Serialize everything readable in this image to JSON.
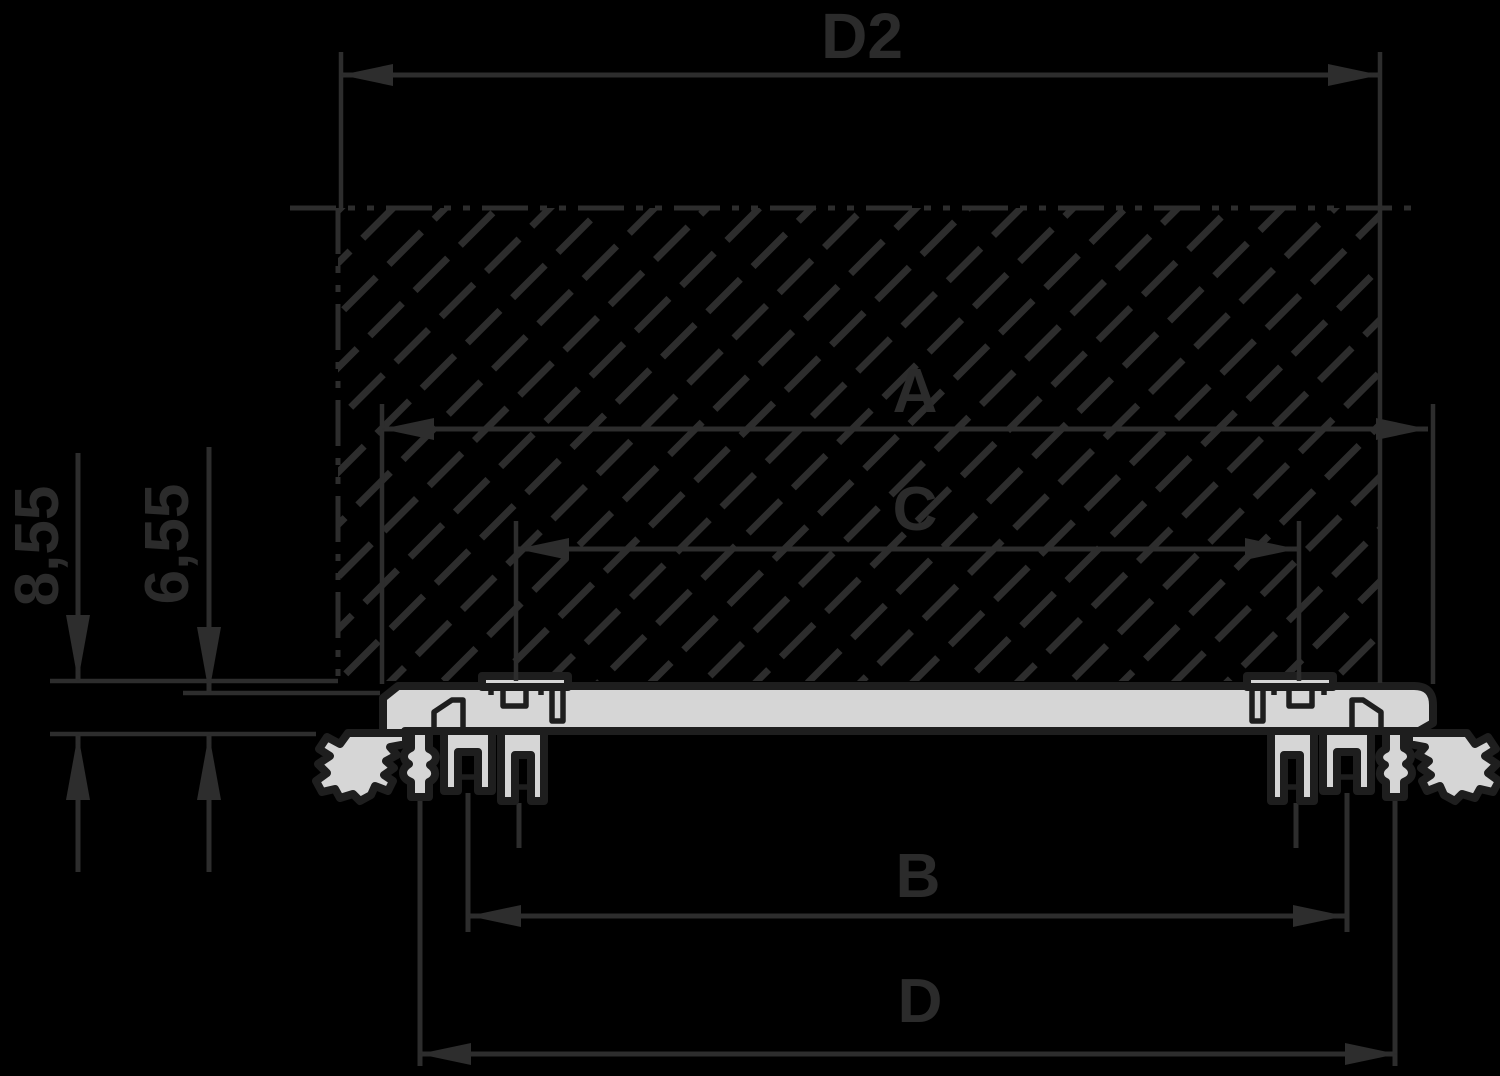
{
  "drawing_title": "Front panel profile cross-section with board clearance dimensions",
  "colors": {
    "background": "#000000",
    "line": "#2d2d2d",
    "text": "#2b2b2b",
    "profile_fill": "#d6d6d6",
    "profile_outline": "#1e1e1e"
  },
  "dimensions": {
    "horizontal": [
      {
        "label": "D2",
        "y": 75,
        "x1": 341,
        "x2": 1380,
        "label_x": 862,
        "label_y": 58,
        "ext": [
          [
            341,
            52,
            341,
            210
          ],
          [
            1380,
            52,
            1380,
            683
          ]
        ]
      },
      {
        "label": "A",
        "y": 429,
        "x1": 382,
        "x2": 1428,
        "label_x": 915,
        "label_y": 412,
        "ext": [
          [
            382,
            404,
            382,
            684
          ],
          [
            1433,
            404,
            1433,
            684
          ]
        ]
      },
      {
        "label": "C",
        "y": 549,
        "x1": 517,
        "x2": 1297,
        "label_x": 915,
        "label_y": 530,
        "ext": [
          [
            516,
            521,
            516,
            681
          ],
          [
            1299,
            521,
            1299,
            681
          ]
        ]
      },
      {
        "label": "B",
        "y": 916,
        "x1": 469,
        "x2": 1345,
        "label_x": 918,
        "label_y": 897,
        "ext": []
      },
      {
        "label": "D",
        "y": 1054,
        "x1": 419,
        "x2": 1397,
        "label_x": 920,
        "label_y": 1022,
        "ext": []
      }
    ],
    "vertical": [
      {
        "label": "8,55",
        "x": 78,
        "tail_top": 453,
        "tip_top": 681,
        "tip_bottom": 734,
        "tail_bottom": 872,
        "label_x": 58,
        "label_y": 546
      },
      {
        "label": "6,55",
        "x": 209,
        "tail_top": 447,
        "tip_top": 693,
        "tip_bottom": 734,
        "tail_bottom": 872,
        "label_x": 188,
        "label_y": 544
      }
    ]
  },
  "reference_lines": [
    [
      50,
      681,
      338,
      681
    ],
    [
      183,
      693,
      380,
      693
    ],
    [
      50,
      734,
      316,
      734
    ]
  ],
  "leader_lines": [
    [
      420,
      799,
      420,
      1066
    ],
    [
      468,
      793,
      468,
      932
    ],
    [
      519,
      803,
      519,
      848
    ],
    [
      1395,
      799,
      1395,
      1066
    ],
    [
      1347,
      793,
      1347,
      932
    ],
    [
      1296,
      803,
      1296,
      848
    ]
  ],
  "phantom_lines": [
    [
      290,
      208,
      1414,
      208
    ],
    [
      338,
      208,
      338,
      681
    ]
  ],
  "hatch_area": {
    "x": 338,
    "y": 208,
    "width": 1042,
    "height": 473
  }
}
